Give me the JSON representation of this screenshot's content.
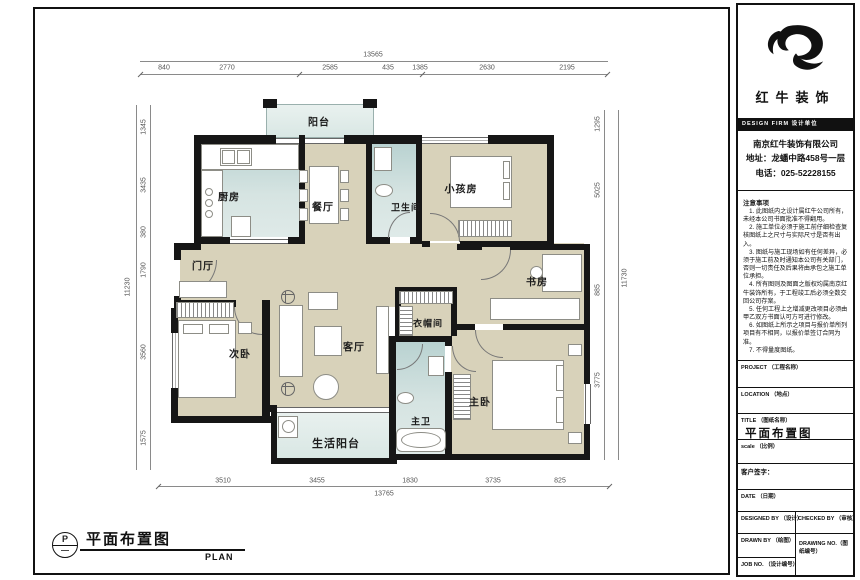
{
  "meta": {
    "colors": {
      "wall": "#161616",
      "floor": "#d8d2ba",
      "wet_area": "#d6e4e2",
      "balcony": "#e9f1ef",
      "paper": "#ffffff"
    }
  },
  "plan": {
    "rooms": [
      {
        "id": "balcony-top",
        "name": "阳台"
      },
      {
        "id": "kitchen",
        "name": "厨房"
      },
      {
        "id": "dining-room",
        "name": "餐厅"
      },
      {
        "id": "bathroom",
        "name": "卫生间"
      },
      {
        "id": "kids-room",
        "name": "小孩房"
      },
      {
        "id": "foyer",
        "name": "门厅"
      },
      {
        "id": "study",
        "name": "书房"
      },
      {
        "id": "second-bedroom",
        "name": "次卧"
      },
      {
        "id": "living-room",
        "name": "客厅"
      },
      {
        "id": "cloakroom",
        "name": "衣帽间"
      },
      {
        "id": "master-bedroom",
        "name": "主卧"
      },
      {
        "id": "master-bath",
        "name": "主卫"
      },
      {
        "id": "living-balcony",
        "name": "生活阳台"
      }
    ],
    "dimensions": {
      "top": {
        "total": "13565",
        "segments": [
          "840",
          "2770",
          "2585",
          "435",
          "1385",
          "2630",
          "2195"
        ]
      },
      "bottom": {
        "total": "13765",
        "segments": [
          "3510",
          "3455",
          "1830",
          "3735",
          "825"
        ]
      },
      "left": {
        "total": "11230",
        "segments": [
          "1345",
          "3435",
          "380",
          "1790",
          "3560",
          "1575"
        ]
      },
      "right": {
        "total": "11730",
        "segments": [
          "1295",
          "5025",
          "885",
          "3775"
        ]
      }
    },
    "caption": {
      "bubble_letter": "P",
      "title": "平面布置图",
      "subtitle": "PLAN"
    }
  },
  "title_block": {
    "logo_text": "红牛装饰",
    "design_firm_bar": "DESIGN FIRM  设计单位",
    "company": {
      "name": "南京红牛装饰有限公司",
      "address": "地址：龙蟠中路458号一层",
      "phone": "电话：025-52228155"
    },
    "notes": {
      "heading": "注意事项",
      "items": [
        "1. 此图纸内之设计属红牛公司所有，未经本公司书面批准不得翻用。",
        "2. 施工单位必须于施工前仔细检查复核图纸上之尺寸与实际尺寸是否有出入。",
        "3. 图纸与施工现场如有任何差异，必须于施工前及时通知本公司有关部门，否则一切责任及后果将由承包之施工单位承担。",
        "4. 所有图则及图面之版权均属南京红牛装饰所有，于工程竣工后必须全数交回公司存案。",
        "5. 任何工程上之增减更改项目必须由甲乙双方书面认可方可进行修改。",
        "6. 如图纸上所示之项目与报价单所列项目有不相同，以报价单签订合同为准。",
        "7. 不得量度图纸。"
      ]
    },
    "fields": [
      {
        "label": "PROJECT （工程名称）",
        "value": ""
      },
      {
        "label": "LOCATION （地点）",
        "value": ""
      },
      {
        "label": "TITLE （图纸名称）",
        "value": "平面布置图"
      },
      {
        "label": "scale （比例）",
        "value": ""
      },
      {
        "label": "客户签字：",
        "value": ""
      },
      {
        "label": "DATE （日期）",
        "value": ""
      },
      {
        "label": "DESIGNED BY （设计）",
        "value": ""
      },
      {
        "label": "CHECKED BY （审核）",
        "value": ""
      },
      {
        "label": "DRAWN BY （绘图）",
        "value": ""
      },
      {
        "label": "DRAWING NO.（图纸编号）",
        "value": ""
      },
      {
        "label": "JOB NO. （设计编号）",
        "value": ""
      }
    ]
  }
}
